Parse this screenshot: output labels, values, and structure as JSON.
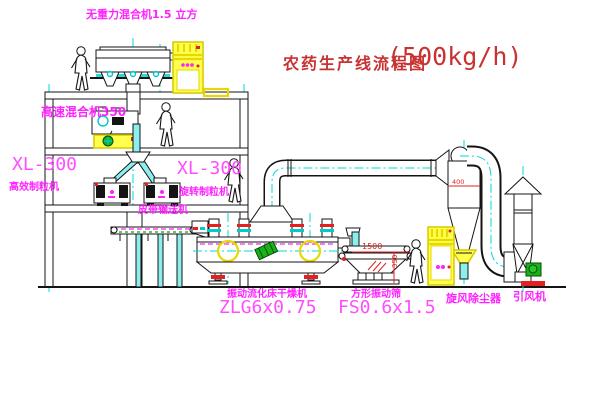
{
  "title": {
    "cn": "农药生产线流程图",
    "capacity": "(500kg/h)"
  },
  "labels": {
    "gravity_mixer": "无重力混合机1.5 立方",
    "high_speed_mixer": "高速混合机350",
    "granulator_left": {
      "model": "XL-300",
      "name": "高效制粒机"
    },
    "granulator_right": {
      "model": "XL-300",
      "name": "旋转制粒机"
    },
    "conveyor": "皮带输送机",
    "dryer": {
      "name": "振动流化床干燥机",
      "model": "ZLG6x0.75"
    },
    "screen": {
      "name": "方形振动筛",
      "model": "FS0.6x1.5"
    },
    "cyclone": "旋风除尘器",
    "fan": "引风机"
  },
  "dimensions": {
    "screen_length": "1500",
    "screen_height": "350",
    "cyclone_inlet": "400"
  },
  "colors": {
    "label_magenta": "#ff22ff",
    "title_red": "#c83232",
    "dimension_red": "#e02020",
    "centerline_cyan": "#00d8d8",
    "cabinet_yellow": "#ffff4d",
    "motor_green": "#19b219",
    "line_black": "#141414"
  }
}
